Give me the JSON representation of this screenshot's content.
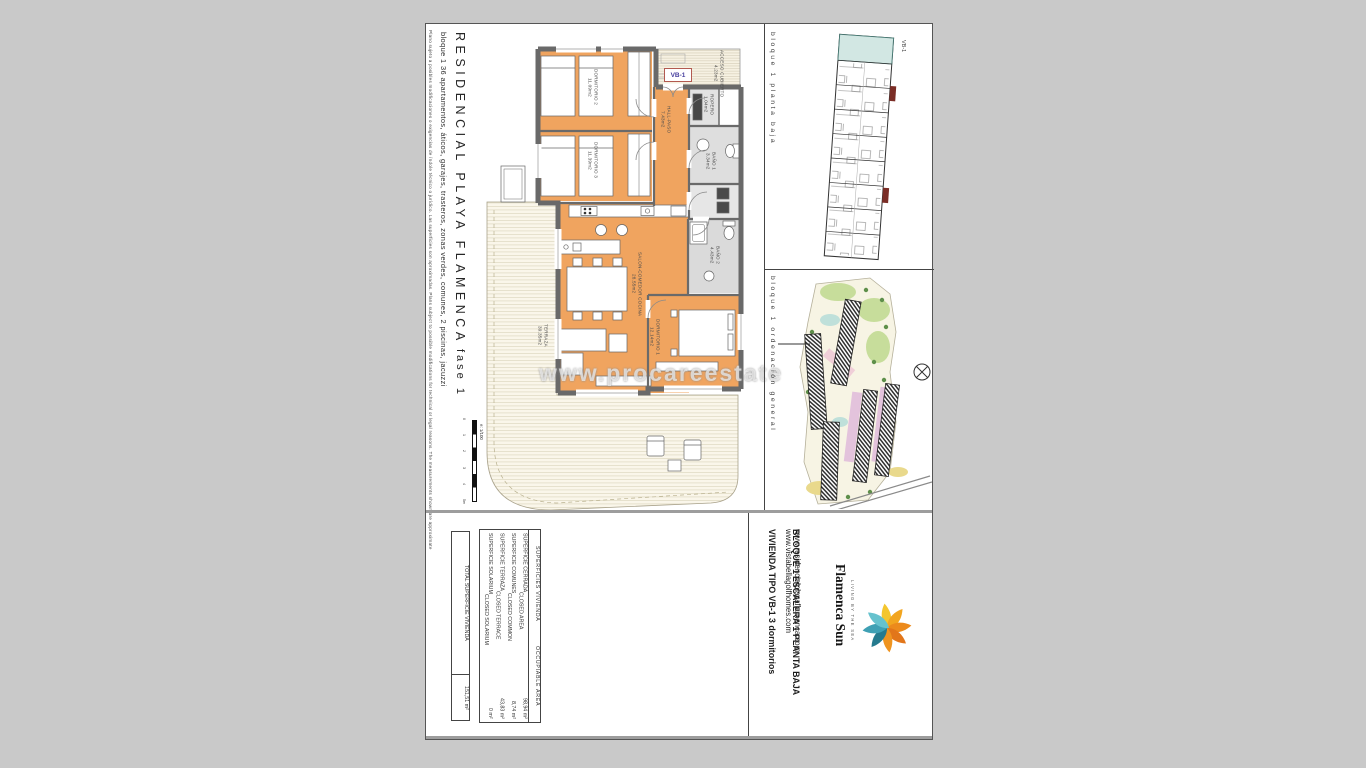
{
  "sheet": {
    "disclaimer": "Plano sujeto a posibles modificaciones o exigencias de índole técnico o jurídico. Las superficies son aproximadas. Plans subject to possible modifications for technical or legal reasons. The measurements shown are approximate",
    "title": "RESIDENCIAL PLAYA FLAMENCA",
    "phase": "fase 1",
    "subtitle": "bloque 1   36 apartamentos, áticos, garajes, trasteros, zonas verdes, comunes, 2 piscinas, jacuzzi",
    "scale_label": "e: 1/100",
    "scale_ticks": [
      "0",
      "1",
      "2",
      "3",
      "4",
      "5m"
    ]
  },
  "floor_plan": {
    "unit_tag": "VB-1",
    "watermark": "www.procareestate",
    "rooms": [
      {
        "name": "ACCESO CUBIERTO",
        "area": "4.23m2"
      },
      {
        "name": "DORMITORIO 2",
        "area": "11.09m2"
      },
      {
        "name": "DORMITORIO 3",
        "area": "11.39m2"
      },
      {
        "name": "HALL-PASO",
        "area": "7.43m2"
      },
      {
        "name": "ROPERO",
        "area": "1.04m2"
      },
      {
        "name": "BAÑO 1",
        "area": "3.34m2"
      },
      {
        "name": "BAÑO 2",
        "area": "4.43m2"
      },
      {
        "name": "SALON-COMEDOR COCINA",
        "area": "28.55m2"
      },
      {
        "name": "DORMITORIO 1",
        "area": "12.14m2"
      },
      {
        "name": "TERRAZA",
        "area": "39.35m2"
      }
    ]
  },
  "panel_planta": {
    "label": "bloque 1 planta baja",
    "unit_tag": "VB-1"
  },
  "panel_ordenacion": {
    "label": "bloque 1 ordenación general"
  },
  "title_block": {
    "surfaces": {
      "header_es": "SUPERFICIES  VIVIENDA",
      "header_en": "OCCUPIABLE  AREA",
      "rows": [
        {
          "es": "SUPERFICIE CERRADA",
          "en": "CLOSED AREA",
          "value": "98,94 m²"
        },
        {
          "es": "SUPERFICIE COMUNES",
          "en": "CLOSED COMMON",
          "value": "8,74 m²"
        },
        {
          "es": "SUPERFICIE TERRAZA",
          "en": "CLOSED TERRACE",
          "value": "43,83 m²"
        },
        {
          "es": "SUPERFICIE SOLARIUM",
          "en": "CLOSED SOLARIUM",
          "value": "0 m²"
        }
      ],
      "total_label": "TOTAL SUPERFICIE VIVIENDA",
      "total_value": "151,51 m²"
    },
    "unit": {
      "type": "VIVIENDA TIPO VB-1",
      "rooms": "3 dormitorios",
      "block": "BLOQUE 1",
      "stair": "ESCALERA 1",
      "floor": "PLANTA BAJA"
    },
    "websites": [
      "www.vistabellagolfhomes.com",
      "www.residencialplayaflamenca.com"
    ],
    "brand": {
      "name": "Flamenca Sun",
      "tagline": "LIVING BY THE SEA"
    }
  }
}
